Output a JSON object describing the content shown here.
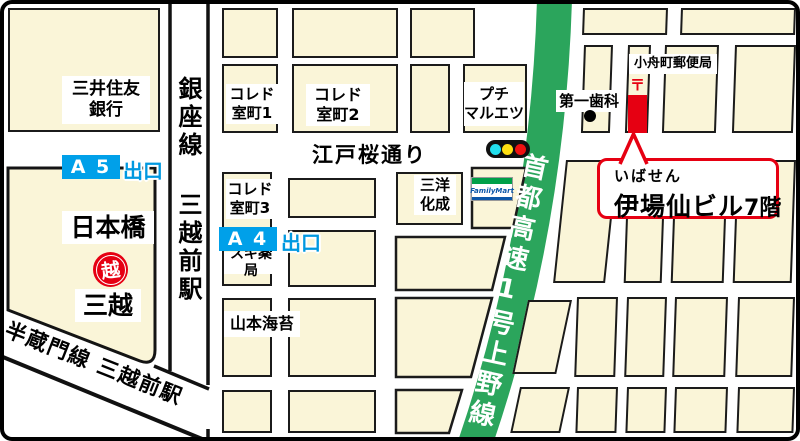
{
  "places": {
    "bank": {
      "line1": "三井住友",
      "line2": "銀行"
    },
    "nihonbashi": "日本橋",
    "mitsukoshi": "三越",
    "mitsukoshi_logo": "越",
    "coredo1": {
      "line1": "コレド",
      "line2": "室町1"
    },
    "coredo2": {
      "line1": "コレド",
      "line2": "室町2"
    },
    "coredo3": {
      "line1": "コレド",
      "line2": "室町3"
    },
    "sugi": "スギ薬局",
    "yamamoto": "山本海苔",
    "sanyo": {
      "line1": "三洋",
      "line2": "化成"
    },
    "maruetsu": {
      "line1": "プチ",
      "line2": "マルエツ"
    },
    "familymart": "FamilyMart",
    "dental": "第一歯科",
    "post_office": "小舟町郵便局",
    "postal_mark": "〒"
  },
  "roads": {
    "edo_sakura": "江戸桜通り",
    "expressway": "首都高速1号上野線",
    "ginza_line": "銀座線 三越前駅",
    "hanzomon_line": "半蔵門線 三越前駅"
  },
  "exits": {
    "a5": {
      "id": "A 5",
      "label": "出口"
    },
    "a4": {
      "id": "A 4",
      "label": "出口"
    }
  },
  "callout": {
    "furigana": "いばせん",
    "building": "伊場仙ビル",
    "floor": "7階"
  },
  "colors": {
    "block_cream": "#faf5d8",
    "expressway_green": "#2ba55c",
    "exit_blue": "#00a0e9",
    "accent_red": "#e60012",
    "traffic_cyan": "#22dfee",
    "traffic_yellow": "#ffe012",
    "traffic_red": "#ee1111"
  }
}
